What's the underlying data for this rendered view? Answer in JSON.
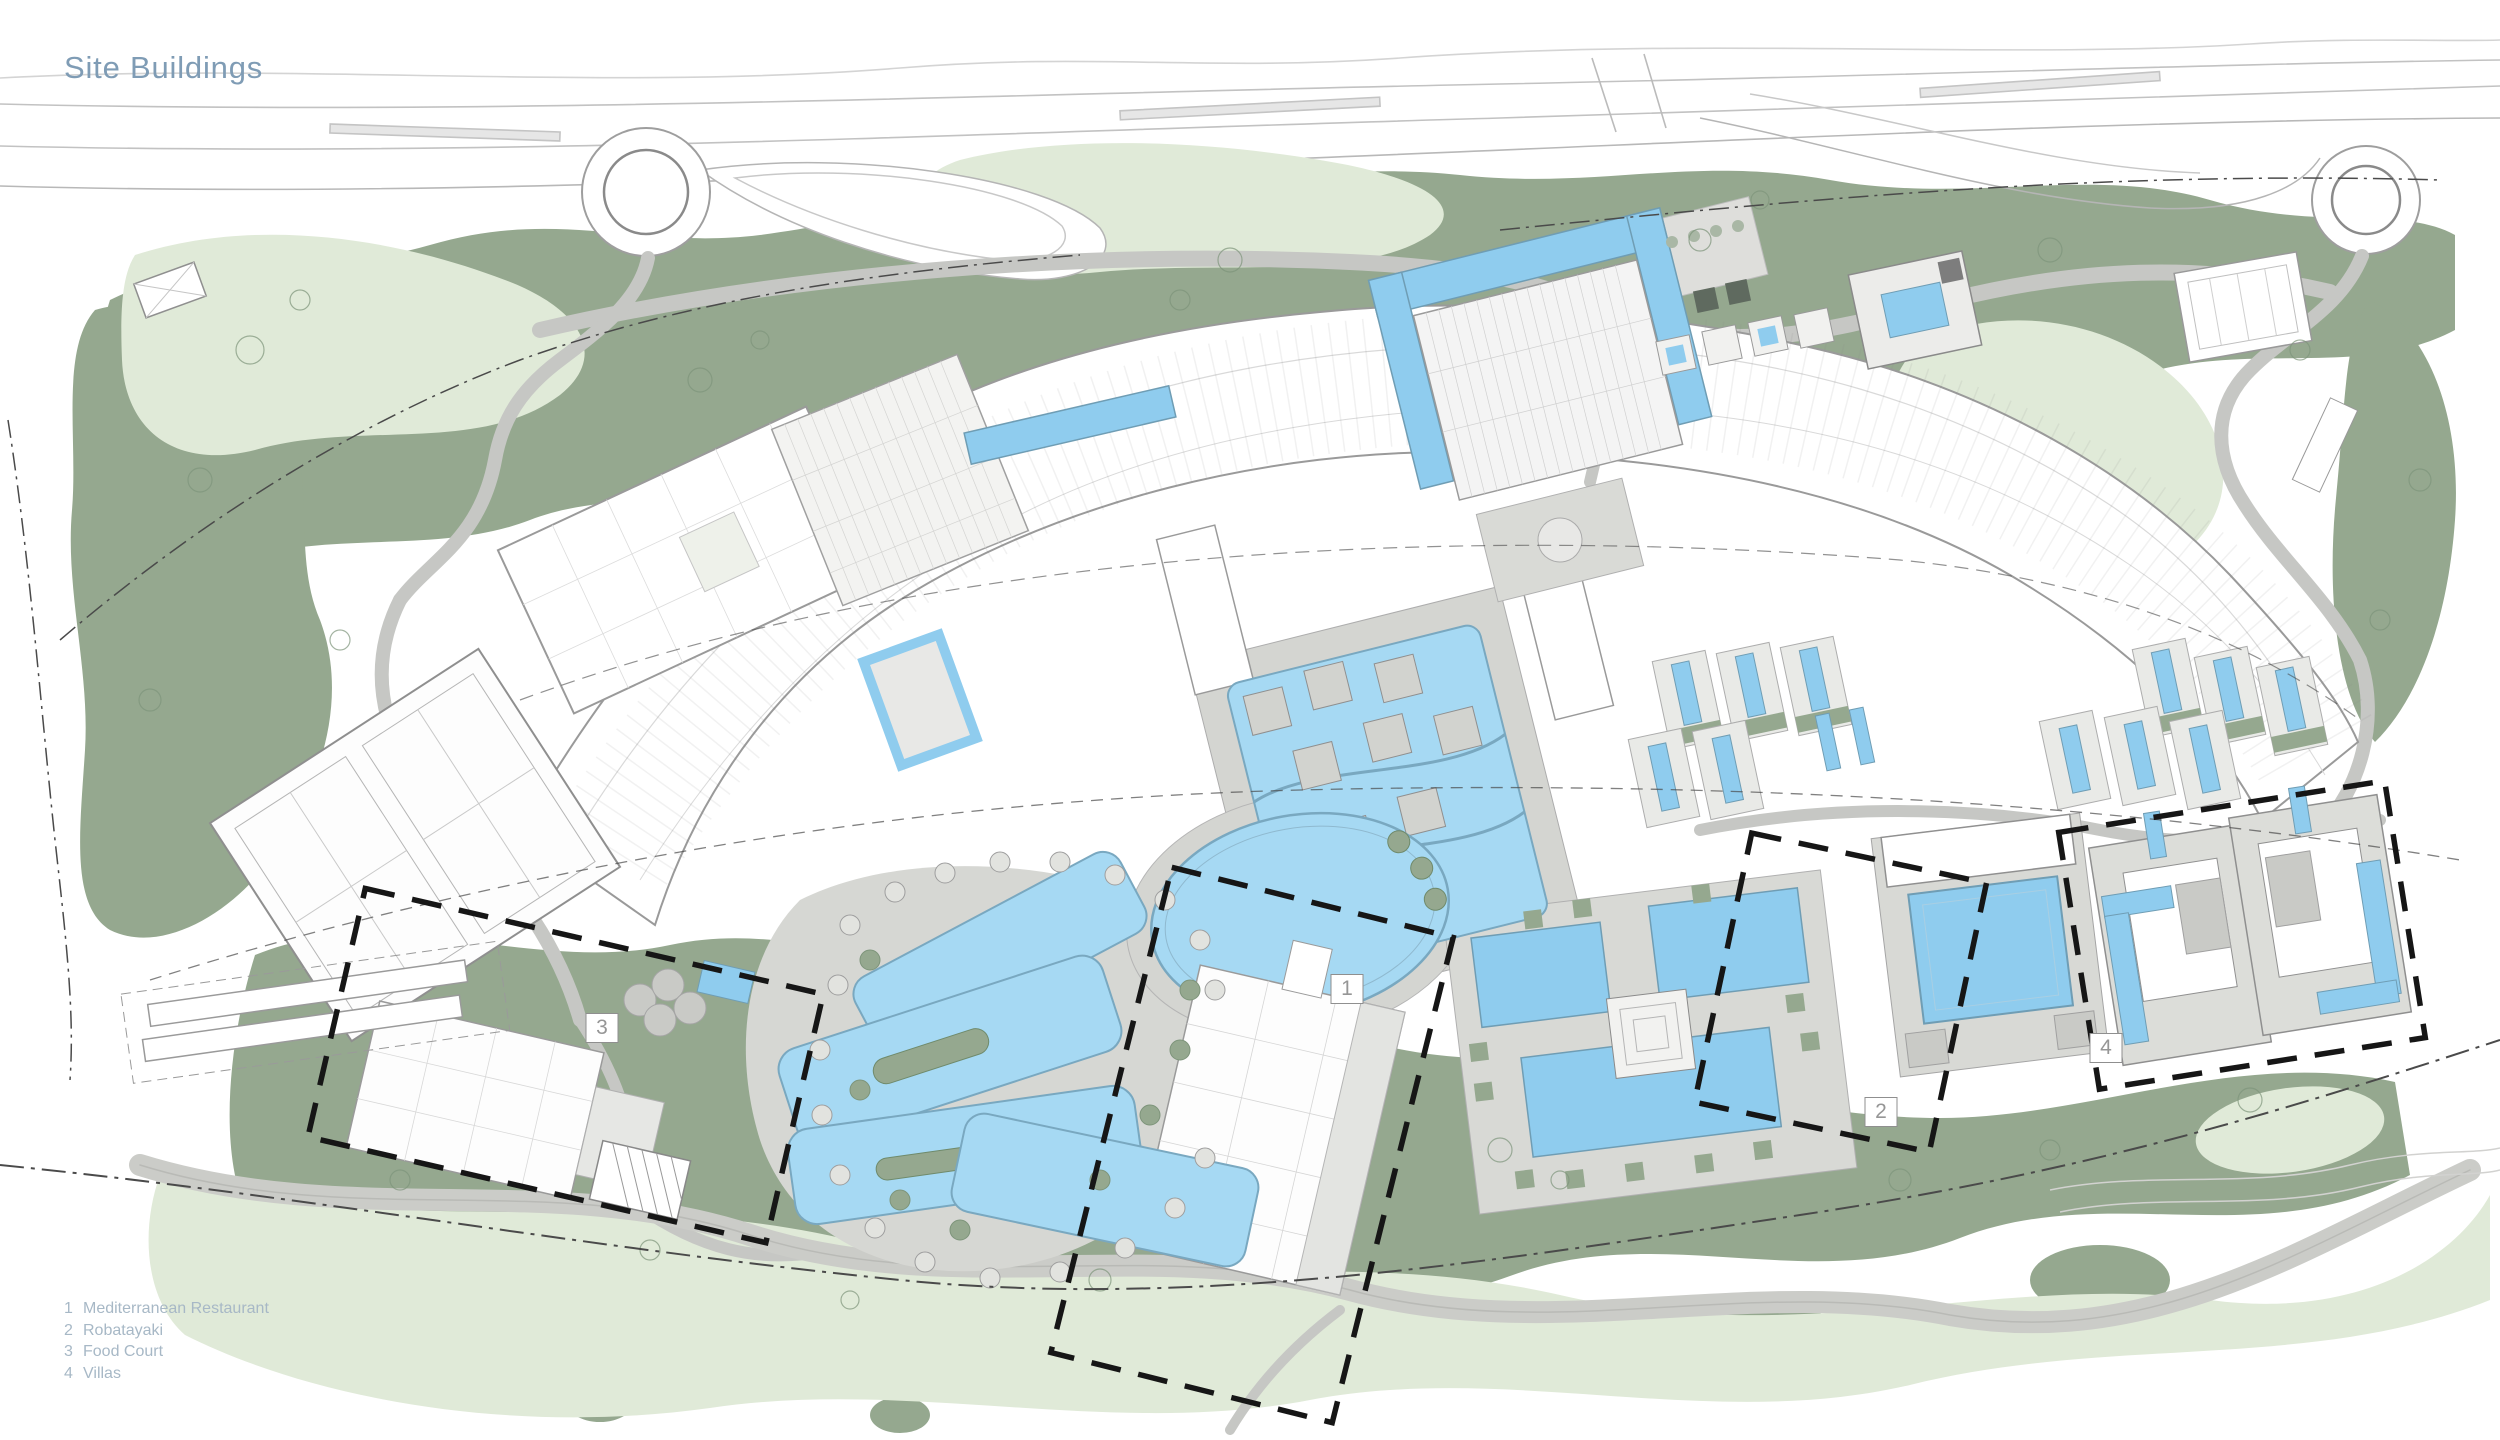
{
  "title": "Site Buildings",
  "legend": {
    "items": [
      {
        "num": "1",
        "name": "Mediterranean Restaurant"
      },
      {
        "num": "2",
        "name": "Robatayaki"
      },
      {
        "num": "3",
        "name": "Food Court"
      },
      {
        "num": "4",
        "name": "Villas"
      }
    ]
  },
  "markers": [
    {
      "label": "1"
    },
    {
      "label": "2"
    },
    {
      "label": "3"
    },
    {
      "label": "4"
    }
  ],
  "colors": {
    "title_text": "#7f9cb5",
    "legend_text": "#a7b8c6",
    "pool_blue": "#a6d9f3",
    "pool_blue_bright": "#8fccee",
    "pool_edge": "#6f9db4",
    "landscape_green": "#95a88f",
    "lawn_green": "#e0ead8",
    "road_gray": "#c6c7c4",
    "paving_gray": "#d8d9d5",
    "building_white": "#ffffff",
    "building_outline": "#9a9a9a",
    "boundary_black": "#161616"
  }
}
